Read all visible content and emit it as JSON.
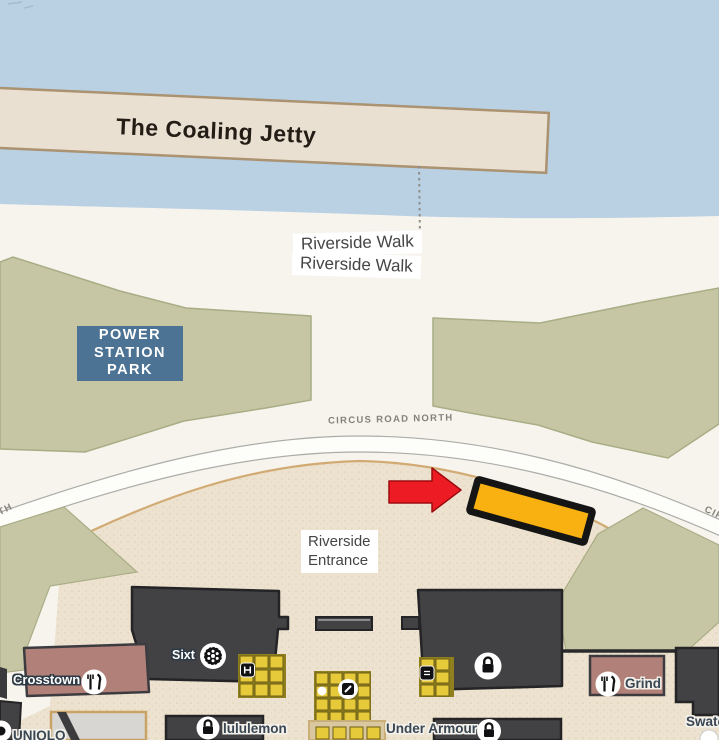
{
  "map": {
    "jetty": {
      "label": "The Coaling Jetty"
    },
    "walk": {
      "label1": "Riverside Walk",
      "label2": "Riverside Walk"
    },
    "park_sign": {
      "line1": "POWER",
      "line2": "STATION",
      "line3": "PARK"
    },
    "road": {
      "name": "CIRCUS ROAD NORTH",
      "frag_left": "TH",
      "frag_right": "CIR"
    },
    "entrance": {
      "line1": "Riverside",
      "line2": "Entrance"
    },
    "stores": {
      "crosstown": "Crosstown",
      "sixt": "Sixt",
      "grind": "Grind",
      "lululemon": "lululemon",
      "under_armour": "Under Armour",
      "uniqlo": "UNIQLO",
      "swatch": "Swatch"
    },
    "colors": {
      "highlight_fill": "#F8B111",
      "highlight_border": "#151515",
      "arrow": "#ED1C24",
      "park_sign_bg": "#4C7394",
      "water": "#BAD0E3",
      "park_green": "#C6C6A4",
      "building_dark": "#424245",
      "retail_pink": "#B18078",
      "plaza_tan": "#ECE2CF"
    }
  }
}
